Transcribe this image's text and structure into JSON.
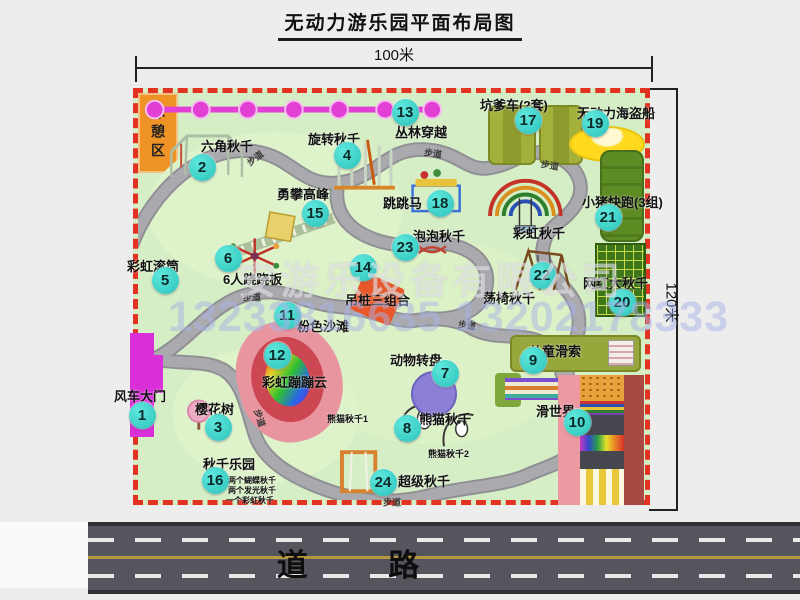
{
  "title": "无动力游乐园平面布局图",
  "dims": {
    "top": "100米",
    "right": "120米"
  },
  "watermark": {
    "company": "安游乐设备有限公司",
    "phone": "13233816635 13202178333"
  },
  "road": {
    "label": "道 路"
  },
  "rest_area": {
    "label": "休憩区"
  },
  "map": {
    "markers": [
      {
        "n": "1",
        "x": 4,
        "y": 322
      },
      {
        "n": "2",
        "x": 64,
        "y": 74
      },
      {
        "n": "3",
        "x": 80,
        "y": 334
      },
      {
        "n": "4",
        "x": 209,
        "y": 62
      },
      {
        "n": "5",
        "x": 27,
        "y": 187
      },
      {
        "n": "6",
        "x": 90,
        "y": 165
      },
      {
        "n": "7",
        "x": 307,
        "y": 280
      },
      {
        "n": "8",
        "x": 269,
        "y": 335
      },
      {
        "n": "9",
        "x": 395,
        "y": 267
      },
      {
        "n": "10",
        "x": 439,
        "y": 329
      },
      {
        "n": "11",
        "x": 149,
        "y": 222
      },
      {
        "n": "12",
        "x": 139,
        "y": 262
      },
      {
        "n": "13",
        "x": 267,
        "y": 19
      },
      {
        "n": "14",
        "x": 225,
        "y": 174
      },
      {
        "n": "15",
        "x": 177,
        "y": 120
      },
      {
        "n": "16",
        "x": 77,
        "y": 387
      },
      {
        "n": "17",
        "x": 390,
        "y": 27
      },
      {
        "n": "18",
        "x": 302,
        "y": 110
      },
      {
        "n": "19",
        "x": 457,
        "y": 30
      },
      {
        "n": "20",
        "x": 484,
        "y": 209
      },
      {
        "n": "21",
        "x": 470,
        "y": 124
      },
      {
        "n": "22",
        "x": 404,
        "y": 182
      },
      {
        "n": "23",
        "x": 267,
        "y": 154
      },
      {
        "n": "24",
        "x": 245,
        "y": 389
      }
    ],
    "labels": [
      {
        "t": "风车大门",
        "x": -24,
        "y": 293
      },
      {
        "t": "六角秋千",
        "x": 63,
        "y": 43
      },
      {
        "t": "樱花树",
        "x": 57,
        "y": 306
      },
      {
        "t": "旋转秋千",
        "x": 170,
        "y": 36
      },
      {
        "t": "彩虹滚筒",
        "x": -11,
        "y": 163
      },
      {
        "t": "6人跷跷板",
        "x": 85,
        "y": 176
      },
      {
        "t": "勇攀高峰",
        "x": 139,
        "y": 91
      },
      {
        "t": "丛林穿越",
        "x": 257,
        "y": 29
      },
      {
        "t": "跳跳马",
        "x": 245,
        "y": 100
      },
      {
        "t": "泡泡秋千",
        "x": 275,
        "y": 133
      },
      {
        "t": "彩虹秋千",
        "x": 375,
        "y": 130
      },
      {
        "t": "坑爹车(2套)",
        "x": 342,
        "y": 2
      },
      {
        "t": "无动力海盗船",
        "x": 439,
        "y": 10
      },
      {
        "t": "小猪快跑(3组)",
        "x": 444,
        "y": 99
      },
      {
        "t": "网红大秋千",
        "x": 445,
        "y": 180
      },
      {
        "t": "荡椅秋千",
        "x": 345,
        "y": 195
      },
      {
        "t": "吊桩三组合",
        "x": 207,
        "y": 197
      },
      {
        "t": "粉色沙滩",
        "x": 159,
        "y": 223
      },
      {
        "t": "彩虹蹦蹦云",
        "x": 124,
        "y": 279
      },
      {
        "t": "动物转盘",
        "x": 252,
        "y": 257
      },
      {
        "t": "熊猫秋千",
        "x": 281,
        "y": 316
      },
      {
        "t": "熊猫秋千1",
        "x": 189,
        "y": 319,
        "s": 9
      },
      {
        "t": "熊猫秋千2",
        "x": 290,
        "y": 354,
        "s": 9
      },
      {
        "t": "儿童滑索",
        "x": 391,
        "y": 248
      },
      {
        "t": "滑世界",
        "x": 398,
        "y": 308
      },
      {
        "t": "超级秋千",
        "x": 260,
        "y": 378
      },
      {
        "t": "秋千乐园",
        "x": 65,
        "y": 361
      },
      {
        "t": "两个蝴蝶秋千",
        "x": 90,
        "y": 382,
        "s": 8
      },
      {
        "t": "两个发光秋千",
        "x": 90,
        "y": 392,
        "s": 8
      },
      {
        "t": "一个彩虹秋千",
        "x": 88,
        "y": 402,
        "s": 8
      }
    ],
    "path_labels": [
      {
        "t": "步道",
        "x": 117,
        "y": 65,
        "r": -38
      },
      {
        "t": "步道",
        "x": 295,
        "y": 60,
        "r": 8
      },
      {
        "t": "步道",
        "x": 412,
        "y": 72,
        "r": 10
      },
      {
        "t": "步道",
        "x": 114,
        "y": 204,
        "r": 0
      },
      {
        "t": "步道",
        "x": 329,
        "y": 232,
        "r": 8
      },
      {
        "t": "步道",
        "x": 122,
        "y": 325,
        "r": 72
      },
      {
        "t": "步道",
        "x": 254,
        "y": 409,
        "r": 0
      }
    ]
  }
}
